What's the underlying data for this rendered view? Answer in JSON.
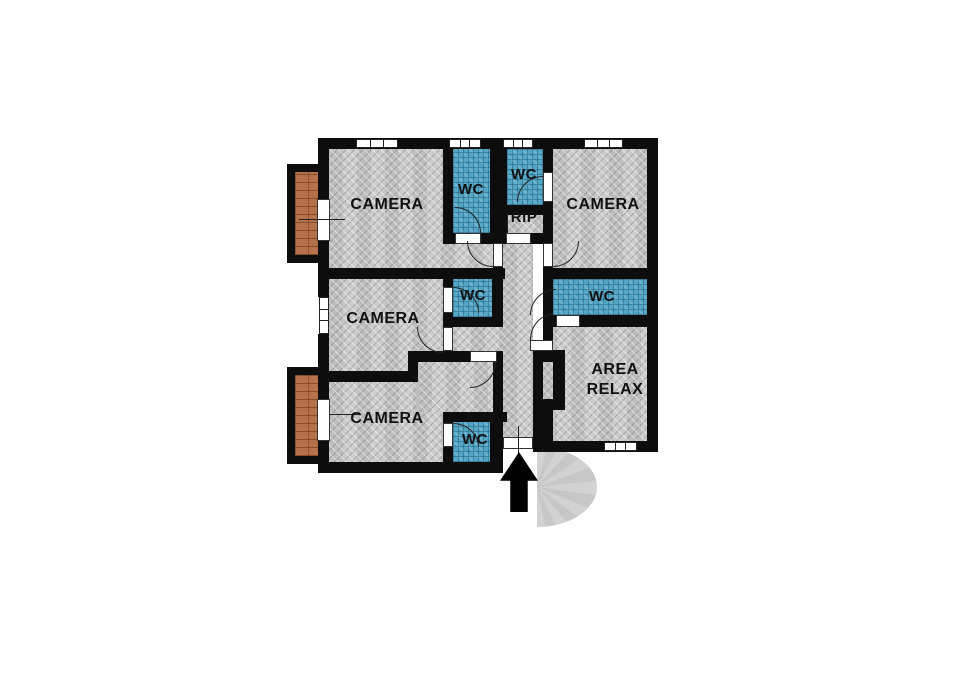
{
  "rooms": {
    "camera_top_left": {
      "label": "CAMERA"
    },
    "wc_top_left": {
      "label": "WC"
    },
    "wc_top_middle": {
      "label": "WC"
    },
    "storage_rip": {
      "label": "RIP"
    },
    "camera_top_right": {
      "label": "CAMERA"
    },
    "camera_middle": {
      "label": "CAMERA"
    },
    "wc_middle": {
      "label": "WC"
    },
    "wc_right": {
      "label": "WC"
    },
    "camera_bottom": {
      "label": "CAMERA"
    },
    "wc_bottom": {
      "label": "WC"
    },
    "area_relax": {
      "label": "AREA RELAX"
    }
  },
  "colors": {
    "wall": "#0d0d0d",
    "floor": "#c8c8c8",
    "wc_tile": "#54a6c6",
    "balcony_brick": "#b5714a",
    "staircase": "#d2d2d2",
    "door_window": "#ffffff",
    "background": "#ffffff",
    "label_text": "#111111"
  }
}
